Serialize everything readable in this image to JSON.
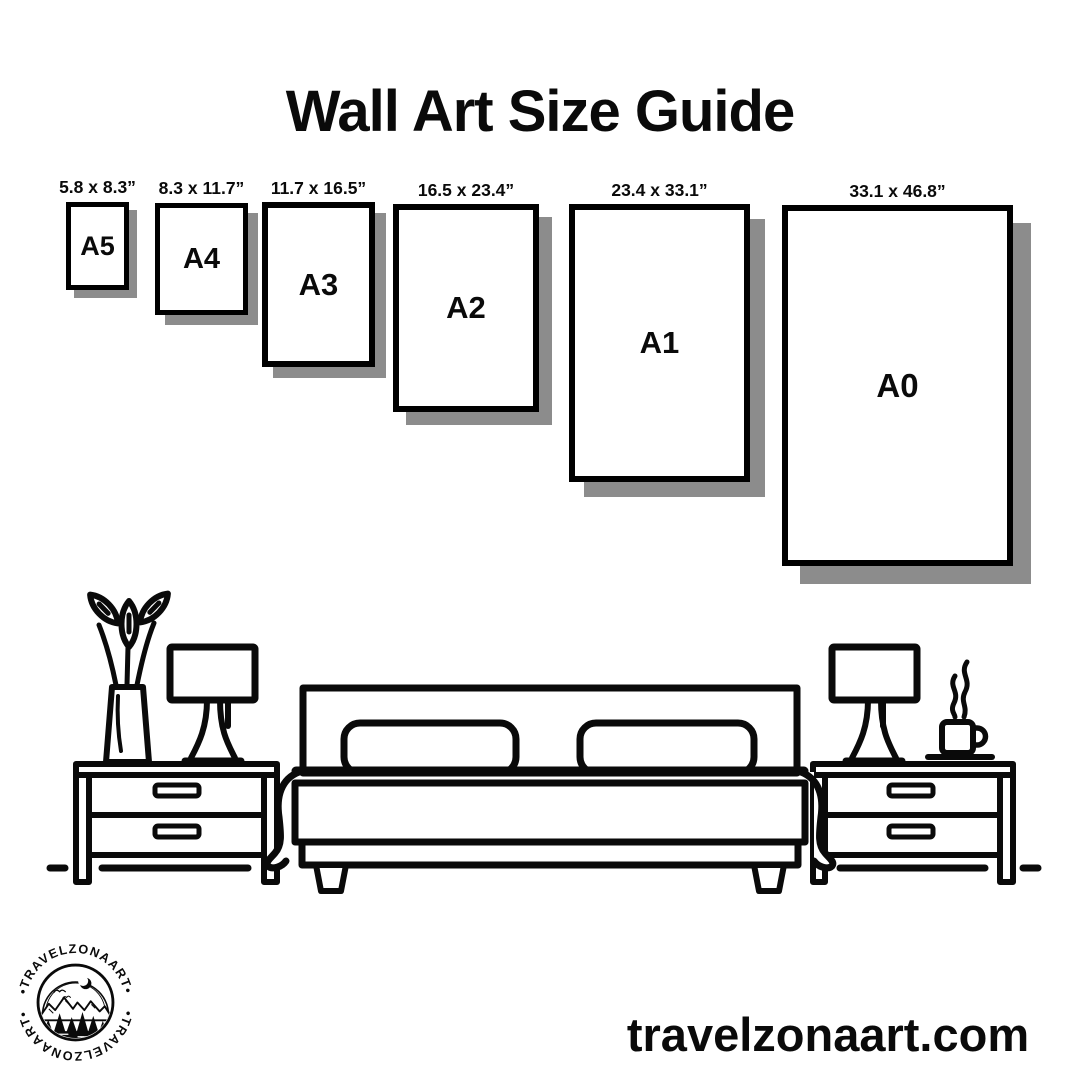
{
  "title": "Wall Art Size Guide",
  "sizes": [
    {
      "code": "A5",
      "dims": "5.8 x 8.3”"
    },
    {
      "code": "A4",
      "dims": "8.3 x 11.7”"
    },
    {
      "code": "A3",
      "dims": "11.7 x 16.5”"
    },
    {
      "code": "A2",
      "dims": "16.5 x 23.4”"
    },
    {
      "code": "A1",
      "dims": "23.4 x 33.1”"
    },
    {
      "code": "A0",
      "dims": "33.1 x 46.8”"
    }
  ],
  "illustration": {
    "items": [
      "flower-vase",
      "table-lamp-left",
      "nightstand-left",
      "double-bed",
      "table-lamp-right",
      "coffee-cup",
      "nightstand-right"
    ]
  },
  "footer": {
    "website": "travelzonaart.com",
    "logo_arc_text": "•TRAVELZONAART•"
  },
  "colors": {
    "ink": "#000000",
    "paper": "#ffffff",
    "shadow": "#8c8c8c"
  }
}
